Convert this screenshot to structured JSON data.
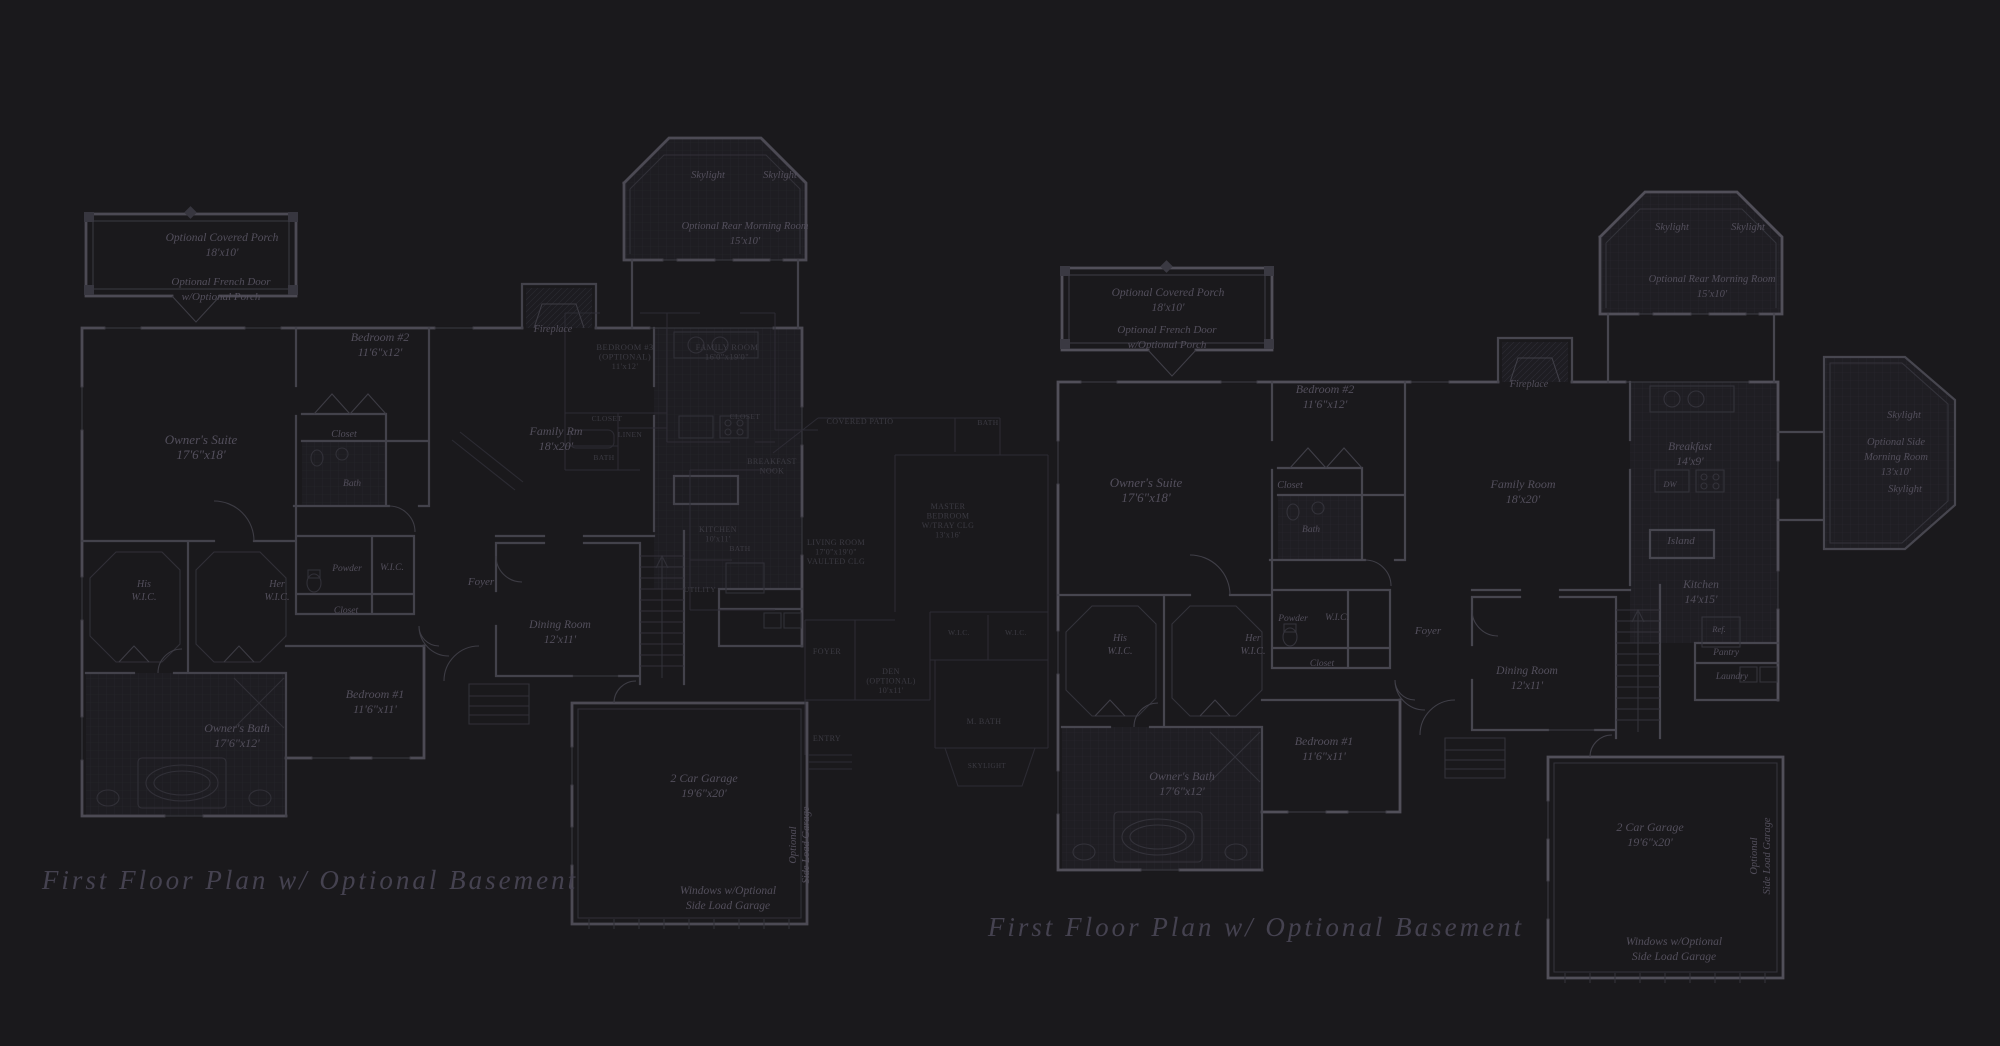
{
  "colors": {
    "background": "#1a191c",
    "wall_line": "#47464f",
    "bright_line": "#514f59",
    "dim_line": "#34333b",
    "ghost_line": "#2f2e36",
    "label_text": "#534f5c",
    "ghost_text": "#3c3b43",
    "title_text": "#454250"
  },
  "titles": [
    {
      "text": "First Floor Plan  w/ Optional Basement",
      "x": 310,
      "y": 889,
      "size": 27
    },
    {
      "text": "First Floor Plan  w/ Optional Basement",
      "x": 1256,
      "y": 936,
      "size": 27
    }
  ],
  "plans": {
    "left": {
      "name": "first-floor-plan-left",
      "labels": [
        {
          "x": 222,
          "y": 241,
          "size": 11.5,
          "lines": [
            "Optional Covered Porch",
            "18'x10'"
          ]
        },
        {
          "x": 221,
          "y": 285,
          "size": 11,
          "lines": [
            "Optional French Door",
            "w/Optional Porch"
          ]
        },
        {
          "x": 380,
          "y": 341,
          "size": 12,
          "lines": [
            "Bedroom #2",
            "11'6\"x12'"
          ]
        },
        {
          "x": 344,
          "y": 437,
          "size": 10,
          "lines": [
            "Closet"
          ]
        },
        {
          "x": 352,
          "y": 486,
          "size": 9.5,
          "lines": [
            "Bath"
          ]
        },
        {
          "x": 201,
          "y": 444,
          "size": 13,
          "lines": [
            "Owner's Suite",
            "17'6\"x18'"
          ]
        },
        {
          "x": 144,
          "y": 587,
          "size": 10,
          "lines": [
            "His",
            "W.I.C."
          ],
          "lh": 13
        },
        {
          "x": 277,
          "y": 587,
          "size": 10,
          "lines": [
            "Her",
            "W.I.C."
          ],
          "lh": 13
        },
        {
          "x": 347,
          "y": 571,
          "size": 9.5,
          "lines": [
            "Powder"
          ]
        },
        {
          "x": 392,
          "y": 570,
          "size": 9.5,
          "lines": [
            "W.I.C."
          ]
        },
        {
          "x": 346,
          "y": 613,
          "size": 9.5,
          "lines": [
            "Closet"
          ]
        },
        {
          "x": 481,
          "y": 585,
          "size": 11,
          "lines": [
            "Foyer"
          ]
        },
        {
          "x": 556,
          "y": 435,
          "size": 12,
          "lines": [
            "Family Rm",
            "18'x20'"
          ]
        },
        {
          "x": 553,
          "y": 332,
          "size": 10,
          "lines": [
            "Fireplace"
          ]
        },
        {
          "x": 708,
          "y": 178,
          "size": 10.5,
          "lines": [
            "Skylight"
          ]
        },
        {
          "x": 780,
          "y": 178,
          "size": 10.5,
          "lines": [
            "Skylight"
          ]
        },
        {
          "x": 745,
          "y": 229,
          "size": 10.5,
          "lines": [
            "Optional Rear Morning Room",
            "15'x10'"
          ]
        },
        {
          "x": 560,
          "y": 628,
          "size": 11.5,
          "lines": [
            "Dining Room",
            "12'x11'"
          ]
        },
        {
          "x": 375,
          "y": 698,
          "size": 12,
          "lines": [
            "Bedroom #1",
            "11'6\"x11'"
          ]
        },
        {
          "x": 237,
          "y": 732,
          "size": 12,
          "lines": [
            "Owner's Bath",
            "17'6\"x12'"
          ]
        },
        {
          "x": 704,
          "y": 782,
          "size": 12,
          "lines": [
            "2 Car Garage",
            "19'6\"x20'"
          ]
        },
        {
          "x": 796,
          "y": 845,
          "size": 10.5,
          "lines": [
            "Optional",
            "Side Load Garage"
          ],
          "rotate": -90,
          "lh": 13
        },
        {
          "x": 728,
          "y": 894,
          "size": 11.5,
          "lines": [
            "Windows w/Optional",
            "Side Load Garage"
          ]
        }
      ]
    },
    "center": {
      "name": "ghost-plan-center",
      "style": "caps",
      "labels": [
        {
          "x": 625,
          "y": 350,
          "size": 8.5,
          "lines": [
            "BEDROOM #3",
            "(OPTIONAL)",
            "11'x12'"
          ]
        },
        {
          "x": 727,
          "y": 350,
          "size": 8.5,
          "lines": [
            "FAMILY ROOM",
            "16'0\"x19'0\""
          ]
        },
        {
          "x": 607,
          "y": 421,
          "size": 7.5,
          "lines": [
            "CLOSET"
          ]
        },
        {
          "x": 630,
          "y": 437,
          "size": 7.5,
          "lines": [
            "LINEN"
          ]
        },
        {
          "x": 604,
          "y": 460,
          "size": 7.5,
          "lines": [
            "BATH"
          ]
        },
        {
          "x": 745,
          "y": 419,
          "size": 7.5,
          "lines": [
            "CLOSET"
          ]
        },
        {
          "x": 740,
          "y": 551,
          "size": 7.5,
          "lines": [
            "BATH"
          ]
        },
        {
          "x": 772,
          "y": 464,
          "size": 8,
          "lines": [
            "BREAKFAST",
            "NOOK"
          ]
        },
        {
          "x": 860,
          "y": 424,
          "size": 8,
          "lines": [
            "COVERED PATIO"
          ]
        },
        {
          "x": 988,
          "y": 425,
          "size": 7.5,
          "lines": [
            "BATH"
          ]
        },
        {
          "x": 718,
          "y": 532,
          "size": 8,
          "lines": [
            "KITCHEN",
            "10'x11'"
          ]
        },
        {
          "x": 836,
          "y": 545,
          "size": 8,
          "lines": [
            "LIVING ROOM",
            "17'0\"x19'0\"",
            "VAULTED CLG"
          ]
        },
        {
          "x": 948,
          "y": 509,
          "size": 8,
          "lines": [
            "MASTER",
            "BEDROOM",
            "W/TRAY CLG",
            "13'x16'"
          ]
        },
        {
          "x": 700,
          "y": 592,
          "size": 7.5,
          "lines": [
            "UTILITY"
          ]
        },
        {
          "x": 827,
          "y": 654,
          "size": 8,
          "lines": [
            "FOYER"
          ]
        },
        {
          "x": 891,
          "y": 674,
          "size": 8,
          "lines": [
            "DEN",
            "(OPTIONAL)",
            "10'x11'"
          ]
        },
        {
          "x": 959,
          "y": 635,
          "size": 7.5,
          "lines": [
            "W.I.C."
          ]
        },
        {
          "x": 1016,
          "y": 635,
          "size": 7.5,
          "lines": [
            "W.I.C."
          ]
        },
        {
          "x": 984,
          "y": 724,
          "size": 8,
          "lines": [
            "M. BATH"
          ]
        },
        {
          "x": 827,
          "y": 741,
          "size": 8,
          "lines": [
            "ENTRY"
          ]
        },
        {
          "x": 987,
          "y": 768,
          "size": 7,
          "lines": [
            "SKYLIGHT"
          ]
        }
      ]
    },
    "right": {
      "name": "first-floor-plan-right",
      "labels": [
        {
          "x": 1168,
          "y": 296,
          "size": 11.5,
          "lines": [
            "Optional Covered Porch",
            "18'x10'"
          ]
        },
        {
          "x": 1167,
          "y": 333,
          "size": 11,
          "lines": [
            "Optional French Door",
            "w/Optional Porch"
          ]
        },
        {
          "x": 1325,
          "y": 393,
          "size": 12,
          "lines": [
            "Bedroom #2",
            "11'6\"x12'"
          ]
        },
        {
          "x": 1290,
          "y": 488,
          "size": 10,
          "lines": [
            "Closet"
          ]
        },
        {
          "x": 1311,
          "y": 532,
          "size": 9.5,
          "lines": [
            "Bath"
          ]
        },
        {
          "x": 1146,
          "y": 487,
          "size": 13,
          "lines": [
            "Owner's Suite",
            "17'6\"x18'"
          ]
        },
        {
          "x": 1120,
          "y": 641,
          "size": 10,
          "lines": [
            "His",
            "W.I.C."
          ],
          "lh": 13
        },
        {
          "x": 1253,
          "y": 641,
          "size": 10,
          "lines": [
            "Her",
            "W.I.C."
          ],
          "lh": 13
        },
        {
          "x": 1293,
          "y": 621,
          "size": 9.5,
          "lines": [
            "Powder"
          ]
        },
        {
          "x": 1337,
          "y": 620,
          "size": 9.5,
          "lines": [
            "W.I.C."
          ]
        },
        {
          "x": 1322,
          "y": 666,
          "size": 9.5,
          "lines": [
            "Closet"
          ]
        },
        {
          "x": 1428,
          "y": 634,
          "size": 11,
          "lines": [
            "Foyer"
          ]
        },
        {
          "x": 1523,
          "y": 488,
          "size": 12,
          "lines": [
            "Family Room",
            "18'x20'"
          ]
        },
        {
          "x": 1529,
          "y": 387,
          "size": 10,
          "lines": [
            "Fireplace"
          ]
        },
        {
          "x": 1672,
          "y": 230,
          "size": 10.5,
          "lines": [
            "Skylight"
          ]
        },
        {
          "x": 1748,
          "y": 230,
          "size": 10.5,
          "lines": [
            "Skylight"
          ]
        },
        {
          "x": 1712,
          "y": 282,
          "size": 10.5,
          "lines": [
            "Optional Rear Morning Room",
            "15'x10'"
          ]
        },
        {
          "x": 1690,
          "y": 450,
          "size": 11.5,
          "lines": [
            "Breakfast",
            "14'x9'"
          ]
        },
        {
          "x": 1670,
          "y": 487,
          "size": 8.5,
          "lines": [
            "DW"
          ]
        },
        {
          "x": 1681,
          "y": 544,
          "size": 11,
          "lines": [
            "Island"
          ]
        },
        {
          "x": 1701,
          "y": 588,
          "size": 11.5,
          "lines": [
            "Kitchen",
            "14'x15'"
          ]
        },
        {
          "x": 1719,
          "y": 632,
          "size": 8.5,
          "lines": [
            "Ref."
          ]
        },
        {
          "x": 1726,
          "y": 655,
          "size": 9.5,
          "lines": [
            "Pantry"
          ]
        },
        {
          "x": 1732,
          "y": 679,
          "size": 9.5,
          "lines": [
            "Laundry"
          ]
        },
        {
          "x": 1904,
          "y": 418,
          "size": 10.5,
          "lines": [
            "Skylight"
          ]
        },
        {
          "x": 1896,
          "y": 445,
          "size": 10.5,
          "lines": [
            "Optional Side",
            "Morning Room",
            "13'x10'"
          ]
        },
        {
          "x": 1905,
          "y": 492,
          "size": 10.5,
          "lines": [
            "Skylight"
          ]
        },
        {
          "x": 1527,
          "y": 674,
          "size": 11.5,
          "lines": [
            "Dining Room",
            "12'x11'"
          ]
        },
        {
          "x": 1324,
          "y": 745,
          "size": 12,
          "lines": [
            "Bedroom #1",
            "11'6\"x11'"
          ]
        },
        {
          "x": 1182,
          "y": 780,
          "size": 12,
          "lines": [
            "Owner's Bath",
            "17'6\"x12'"
          ]
        },
        {
          "x": 1650,
          "y": 831,
          "size": 12,
          "lines": [
            "2 Car Garage",
            "19'6\"x20'"
          ]
        },
        {
          "x": 1757,
          "y": 856,
          "size": 10.5,
          "lines": [
            "Optional",
            "Side Load Garage"
          ],
          "rotate": -90,
          "lh": 13
        },
        {
          "x": 1674,
          "y": 945,
          "size": 11.5,
          "lines": [
            "Windows w/Optional",
            "Side Load Garage"
          ]
        }
      ]
    }
  }
}
